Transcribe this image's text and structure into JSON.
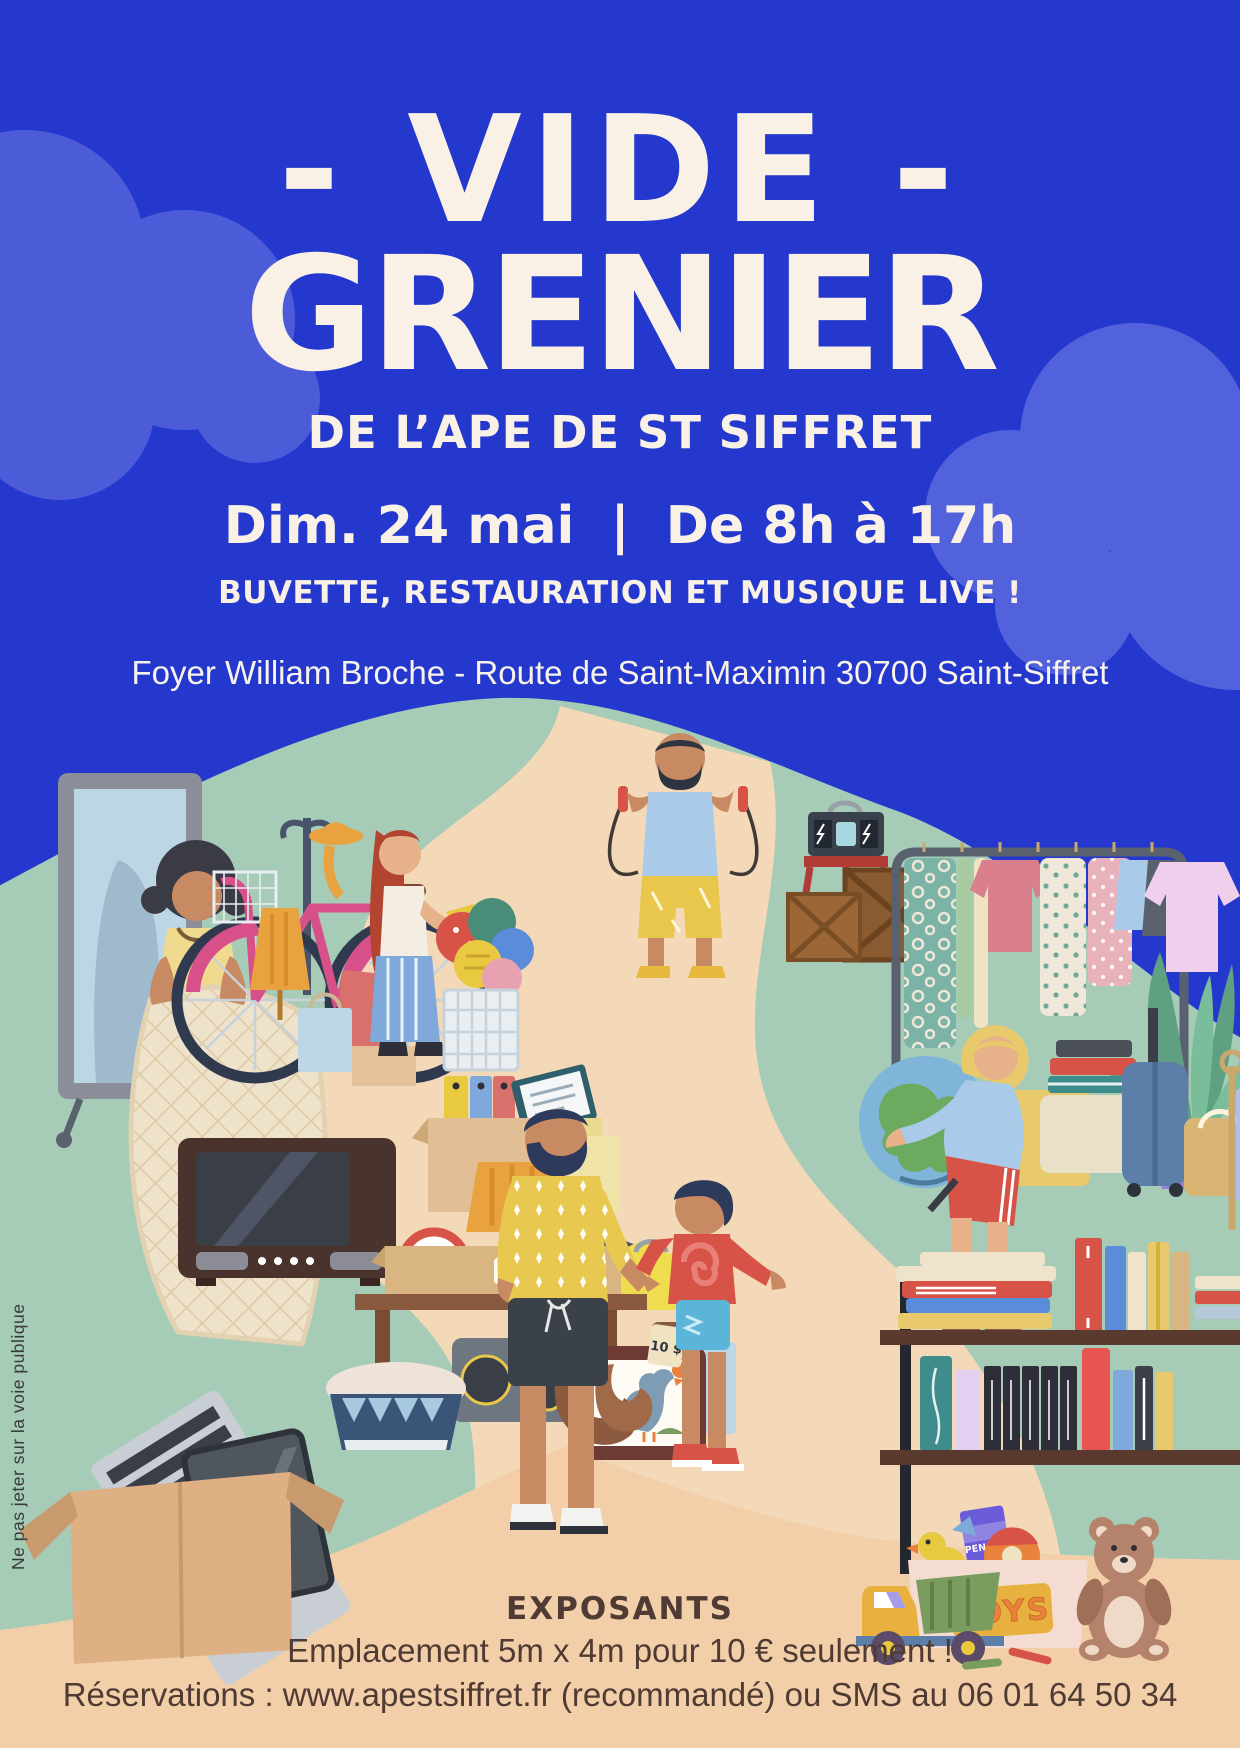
{
  "poster": {
    "title_line1": "- VIDE -",
    "title_line2": "GRENIER",
    "subtitle": "DE L’APE DE ST SIFFRET",
    "schedule": "Dim. 24 mai  |  De 8h à 17h",
    "tagline": "BUVETTE, RESTAURATION ET MUSIQUE LIVE !",
    "address": "Foyer William Broche - Route de Saint-Maximin 30700 Saint-Siffret",
    "side_note": "Ne pas jeter sur la voie publique"
  },
  "footer": {
    "heading": "EXPOSANTS",
    "pricing_line": "Emplacement 5m x 4m pour 10 € seulement !",
    "reservation_line": "Réservations : www.apestsiffret.fr (recommandé) ou SMS au 06 01 64 50 34"
  },
  "illustration": {
    "for_sale_label": "FOR SALE",
    "price_tag_label": "10 $",
    "toys_sign_label": "TOYS",
    "pencils_pack_label": "PENCILS"
  },
  "colors": {
    "background_blue": "#2438CE",
    "cloud_blue": "#4C5CD9",
    "cream_text": "#FAF1E6",
    "hill_green": "#A6CBB7",
    "path_sand": "#F4D9B8",
    "footer_peach": "#F2CFA9",
    "footer_text_brown": "#4F3B33"
  }
}
